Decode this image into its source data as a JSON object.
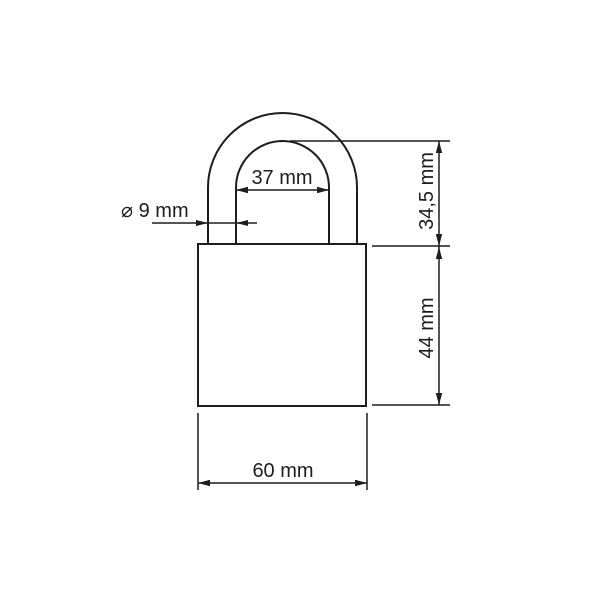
{
  "drawing": {
    "subject": "padlock-dimension-diagram",
    "background_color": "#ffffff",
    "line_color": "#1d1d1d",
    "labels": {
      "shackle_inner_width": "37 mm",
      "shackle_diameter": "⌀ 9 mm",
      "shackle_height": "34,5 mm",
      "body_height": "44 mm",
      "body_width": "60 mm"
    }
  }
}
